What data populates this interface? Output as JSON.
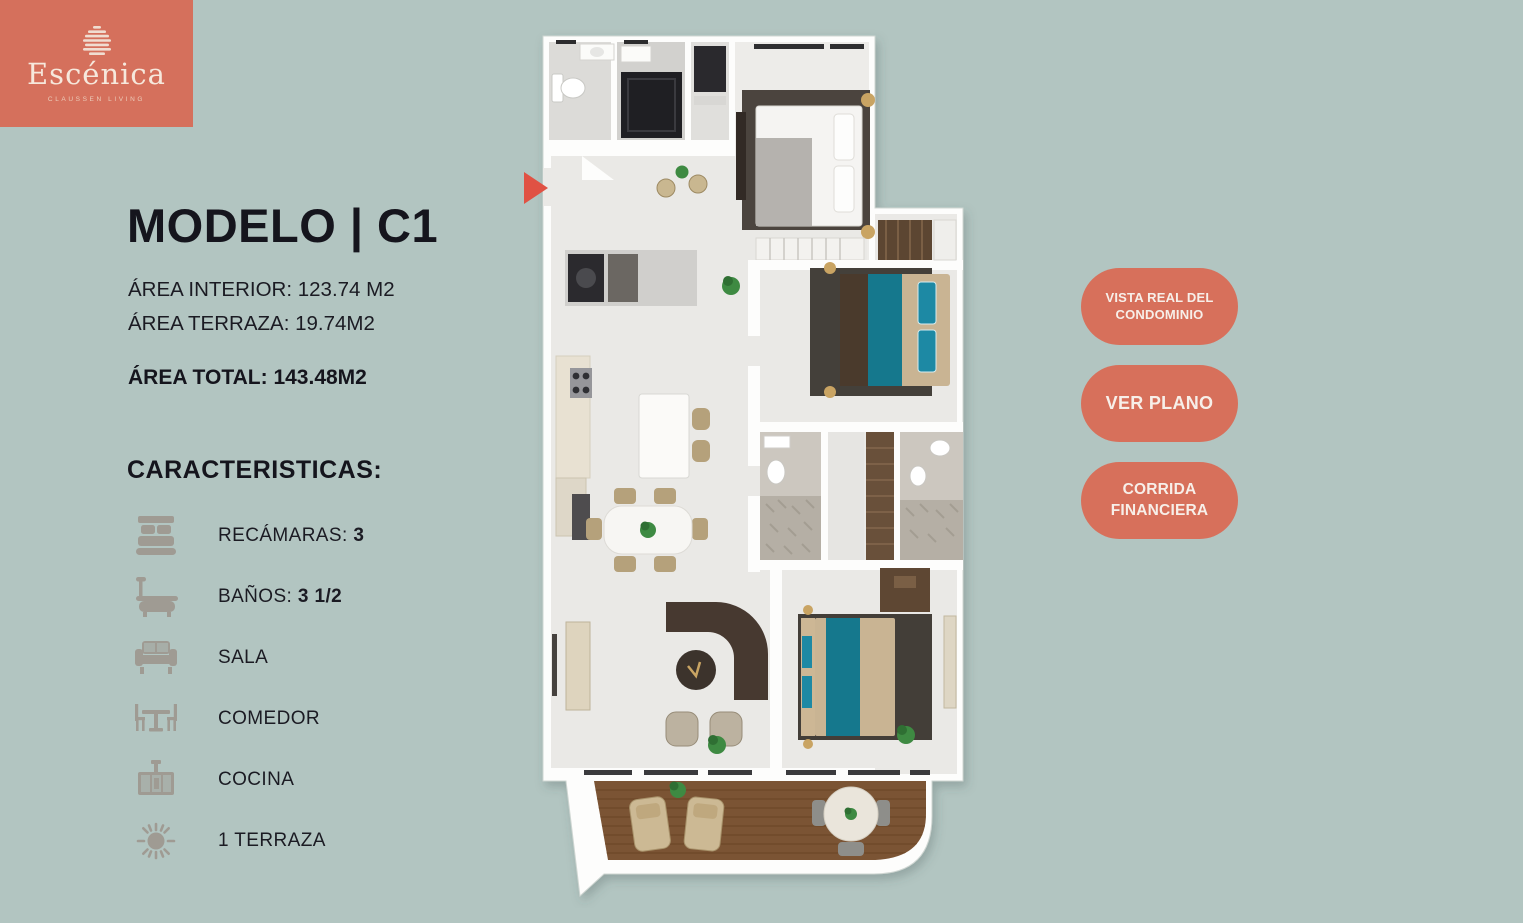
{
  "colors": {
    "background": "#b2c5c1",
    "accent_coral": "#d7705b",
    "text_dark": "#15151d",
    "icon_muted": "#9c928a",
    "bed_teal": "#15788d",
    "deck_wood": "#7b5434"
  },
  "brand": {
    "name": "Escénica",
    "tagline": "CLAUSSEN LIVING"
  },
  "model": {
    "title": "MODELO | C1",
    "areas": [
      {
        "label": "ÁREA INTERIOR:",
        "value": "123.74 M2"
      },
      {
        "label": "ÁREA TERRAZA:",
        "value": "19.74M2"
      },
      {
        "label": "ÁREA TOTAL:",
        "value": "143.48M2"
      }
    ],
    "features_heading": "CARACTERISTICAS:",
    "features": [
      {
        "icon": "bed-icon",
        "label": "RECÁMARAS: ",
        "value": "3"
      },
      {
        "icon": "bathtub-icon",
        "label": "BAÑOS: ",
        "value": "3 1/2"
      },
      {
        "icon": "sofa-icon",
        "label": "SALA",
        "value": ""
      },
      {
        "icon": "dining-table-icon",
        "label": "COMEDOR",
        "value": ""
      },
      {
        "icon": "kitchen-stove-icon",
        "label": "COCINA",
        "value": ""
      },
      {
        "icon": "sun-icon",
        "label": "1 TERRAZA",
        "value": ""
      }
    ]
  },
  "actions": [
    {
      "label": "VISTA REAL DEL CONDOMINIO"
    },
    {
      "label": "VER PLANO"
    },
    {
      "label": "CORRIDA FINANCIERA"
    }
  ]
}
